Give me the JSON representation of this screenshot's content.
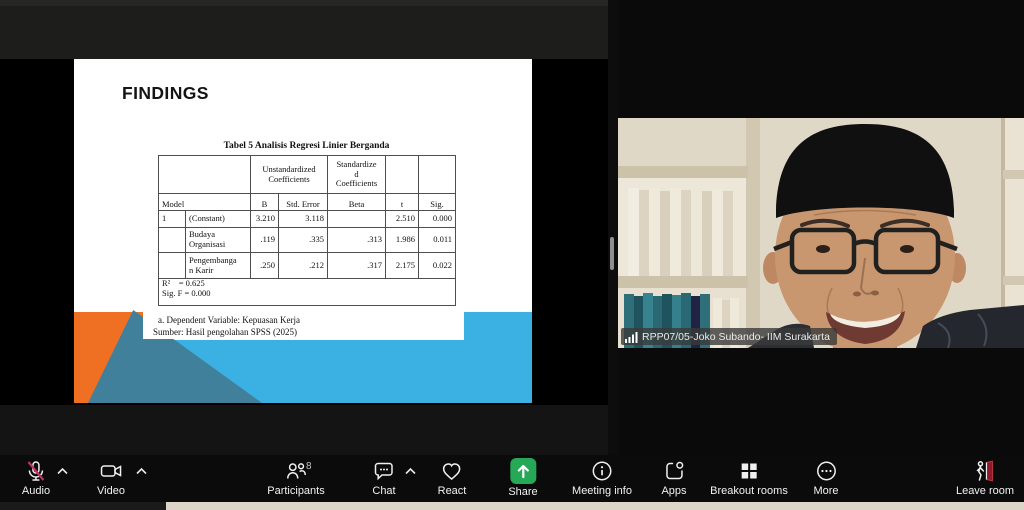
{
  "slide": {
    "title": "FINDINGS",
    "table_title": "Tabel 5 Analisis Regresi Linier Berganda",
    "table": {
      "group_unstd": "Unstandardized Coefficients",
      "group_std": "Standardize\nd\nCoefficients",
      "col_model": "Model",
      "col_b": "B",
      "col_se": "Std. Error",
      "col_beta": "Beta",
      "col_t": "t",
      "col_sig": "Sig.",
      "rows": [
        {
          "no": "1",
          "name": "(Constant)",
          "b": "3.210",
          "se": "3.118",
          "beta": "",
          "t": "2.510",
          "sig": "0.000"
        },
        {
          "no": "",
          "name": "Budaya Organisasi",
          "b": ".119",
          "se": ".335",
          "beta": ".313",
          "t": "1.986",
          "sig": "0.011"
        },
        {
          "no": "",
          "name": "Pengembanga\nn Karir",
          "b": ".250",
          "se": ".212",
          "beta": ".317",
          "t": "2.175",
          "sig": "0.022"
        }
      ],
      "r2_line": "R²    = 0.625",
      "sig_f_line": "Sig. F = 0.000"
    },
    "footnote_a": "a. Dependent Variable: Kepuasan Kerja",
    "footnote_sumber": "Sumber: Hasil pengolahan SPSS (2025)",
    "accent_orange": "#EF7022",
    "accent_blue": "#3BB0E3",
    "accent_teal": "#41809A"
  },
  "video": {
    "participant_label": "RPP07/05-Joko Subando- IIM Surakarta",
    "signal_icon": "signal-bars"
  },
  "toolbar": {
    "items": [
      {
        "label": "Audio",
        "icon": "mic-muted-icon",
        "has_chevron": true
      },
      {
        "label": "Video",
        "icon": "camera-icon",
        "has_chevron": true
      },
      {
        "label": "Participants",
        "icon": "people-icon",
        "badge": "8"
      },
      {
        "label": "Chat",
        "icon": "chat-bubble-icon",
        "has_chevron": true
      },
      {
        "label": "React",
        "icon": "heart-icon"
      },
      {
        "label": "Share",
        "icon": "share-screen-icon",
        "accent": "#27A857"
      },
      {
        "label": "Meeting info",
        "icon": "info-icon"
      },
      {
        "label": "Apps",
        "icon": "apps-icon"
      },
      {
        "label": "Breakout rooms",
        "icon": "breakout-grid-icon"
      },
      {
        "label": "More",
        "icon": "more-dots-icon"
      },
      {
        "label": "Leave room",
        "icon": "leave-door-icon",
        "accent": "#8E1B2B"
      }
    ]
  }
}
